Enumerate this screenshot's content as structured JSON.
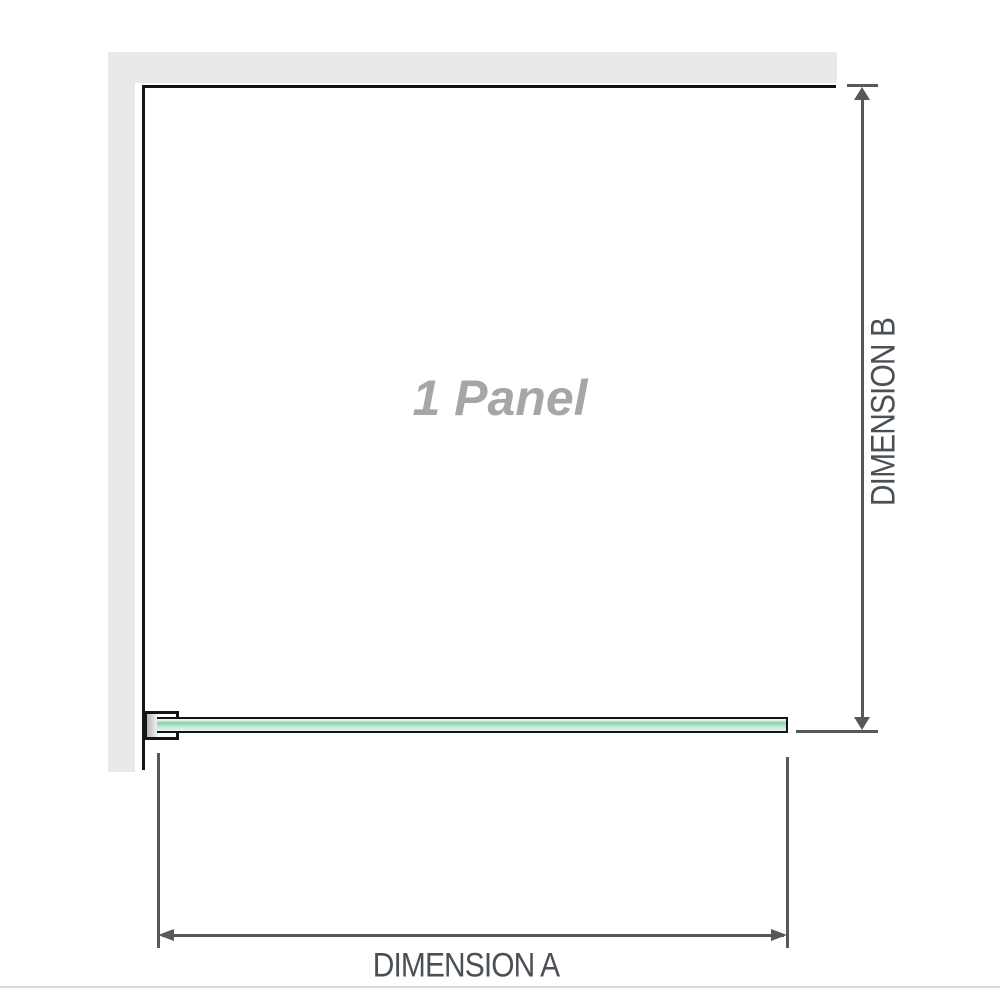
{
  "diagram": {
    "panel_label": "1 Panel",
    "dimension_a_label": "DIMENSION A",
    "dimension_b_label": "DIMENSION B"
  },
  "icons": {
    "dimension_b_top": "arrow-up-icon",
    "dimension_b_bottom": "arrow-down-icon",
    "dimension_a_left": "arrow-left-icon",
    "dimension_a_right": "arrow-right-icon"
  },
  "colors": {
    "wall": "#e9e9e9",
    "panel-edge": "#141414",
    "dimension-line": "#57585a",
    "label-text": "#4b5055",
    "panel-label-text": "#a6a6a6",
    "glass-green": "#8ed2ac",
    "divider": "#dcdad7",
    "bg": "#ffffff"
  }
}
